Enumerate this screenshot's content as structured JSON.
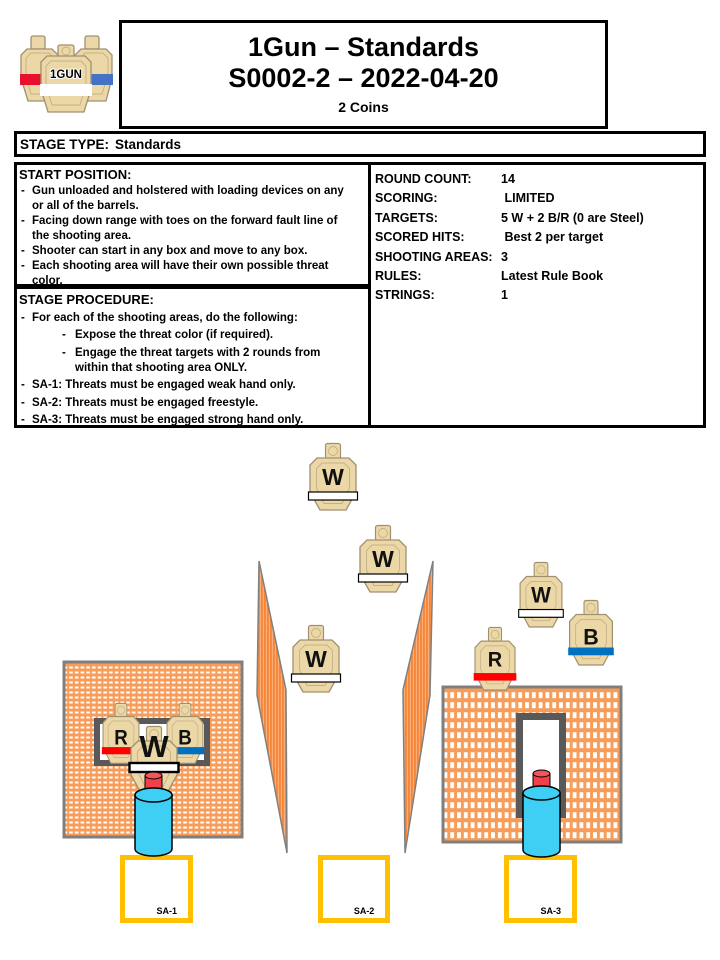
{
  "header": {
    "title_line1": "1Gun – Standards",
    "title_line2": "S0002-2 – 2022-04-20",
    "subtitle": "2 Coins",
    "logo_text": "1GUN"
  },
  "stage_type": {
    "label": "STAGE TYPE:",
    "value": "Standards"
  },
  "start_position": {
    "heading": "START POSITION:",
    "items": [
      "Gun unloaded and holstered with loading devices on any\nor all of the barrels.",
      "Facing down range with toes on the forward fault line of\nthe shooting area.",
      "Shooter can start in any box and move to any box.",
      "Each shooting area will have their own possible threat\ncolor."
    ]
  },
  "stage_info": {
    "rows": [
      {
        "label": "ROUND COUNT:",
        "value": "14"
      },
      {
        "label": "SCORING:",
        "value": " LIMITED"
      },
      {
        "label": "TARGETS:",
        "value": "5 W + 2 B/R (0 are Steel)"
      },
      {
        "label": "SCORED HITS:",
        "value": " Best 2 per target"
      },
      {
        "label": "SHOOTING AREAS:",
        "value": "3"
      },
      {
        "label": "RULES:",
        "value": "Latest Rule Book"
      },
      {
        "label": "STRINGS:",
        "value": "1"
      }
    ]
  },
  "stage_procedure": {
    "heading": "STAGE PROCEDURE:",
    "items": [
      {
        "text": "For each of the shooting areas, do the following:",
        "sub": [
          "Expose the threat color (if required).",
          "Engage the threat targets with 2 rounds from\nwithin that shooting area ONLY."
        ]
      },
      {
        "text": "SA-1: Threats must be engaged weak hand only.",
        "sub": []
      },
      {
        "text": "SA-2: Threats must be engaged freestyle.",
        "sub": []
      },
      {
        "text": "SA-3: Threats must be engaged strong hand only.",
        "sub": []
      }
    ]
  },
  "colors": {
    "wall_orange": "#F79C59",
    "wall_border": "#7F7F7F",
    "frame_gray": "#595959",
    "barrier_orange": "#F5873B",
    "barrier_stripe": "#FBAE77",
    "barrier_edge": "#808080",
    "target_tan": "#EBD8A6",
    "target_outline": "#A09070",
    "target_inner": "#C4B088",
    "band_red": "#FF0000",
    "band_blue": "#0070C0",
    "band_white": "#FFFFFF",
    "barrel_cyan": "#3FCFF4",
    "barrel_cap_red": "#F2404A",
    "barrel_cap_top": "#F4555C",
    "sa_border": "#FFC000",
    "logo_red": "#E8112D",
    "logo_blue": "#4472C4"
  },
  "diagram": {
    "walls": [
      {
        "x": 64,
        "y": 662,
        "w": 178,
        "h": 175,
        "pattern": "h",
        "window": {
          "x": 94,
          "y": 718,
          "w": 116,
          "h": 48,
          "frame": 6
        }
      },
      {
        "x": 443,
        "y": 687,
        "w": 178,
        "h": 155,
        "pattern": "v",
        "window": {
          "x": 516,
          "y": 713,
          "w": 50,
          "h": 105,
          "frame": 7
        }
      }
    ],
    "barriers": [
      {
        "points": "259,561 286,690 287,853 257,695"
      },
      {
        "points": "433,561 430,695 405,853 403,690"
      }
    ],
    "targets": [
      {
        "letter": "W",
        "band": "white",
        "cx": 333,
        "y": 443,
        "sx": 1,
        "sy": 1
      },
      {
        "letter": "W",
        "band": "white",
        "cx": 383,
        "y": 525,
        "sx": 1,
        "sy": 1
      },
      {
        "letter": "W",
        "band": "white",
        "cx": 316,
        "y": 625,
        "sx": 1,
        "sy": 1
      },
      {
        "letter": "W",
        "band": "white",
        "cx": 541,
        "y": 562,
        "sx": 0.91,
        "sy": 0.97
      },
      {
        "letter": "B",
        "band": "blue",
        "cx": 591,
        "y": 600,
        "sx": 0.93,
        "sy": 0.97,
        "ly": 46
      },
      {
        "letter": "R",
        "band": "red",
        "cx": 495,
        "y": 627,
        "sx": 0.87,
        "sy": 0.94
      },
      {
        "letter": "R",
        "band": "red",
        "cx": 121,
        "y": 703,
        "sx": 0.78,
        "sy": 0.9,
        "fs": 24,
        "ly": 46
      },
      {
        "letter": "B",
        "band": "blue",
        "cx": 185,
        "y": 703,
        "sx": 0.78,
        "sy": 0.9,
        "fs": 24,
        "ly": 46
      },
      {
        "letter": "W",
        "band": "white_outlined",
        "cx": 154,
        "y": 726,
        "sx": 1,
        "sy": 1,
        "fs": 31,
        "ly": 31,
        "by": 37,
        "bh": 9
      }
    ],
    "barrels": [
      {
        "cx": 153.5,
        "top": 772,
        "bottom": 856
      },
      {
        "cx": 541.5,
        "top": 770,
        "bottom": 857
      }
    ],
    "shooting_areas": [
      {
        "label": "SA-1",
        "x": 120,
        "y": 855,
        "w": 73,
        "h": 68
      },
      {
        "label": "SA-2",
        "x": 318,
        "y": 855,
        "w": 72,
        "h": 68
      },
      {
        "label": "SA-3",
        "x": 504,
        "y": 855,
        "w": 73,
        "h": 68
      }
    ]
  }
}
